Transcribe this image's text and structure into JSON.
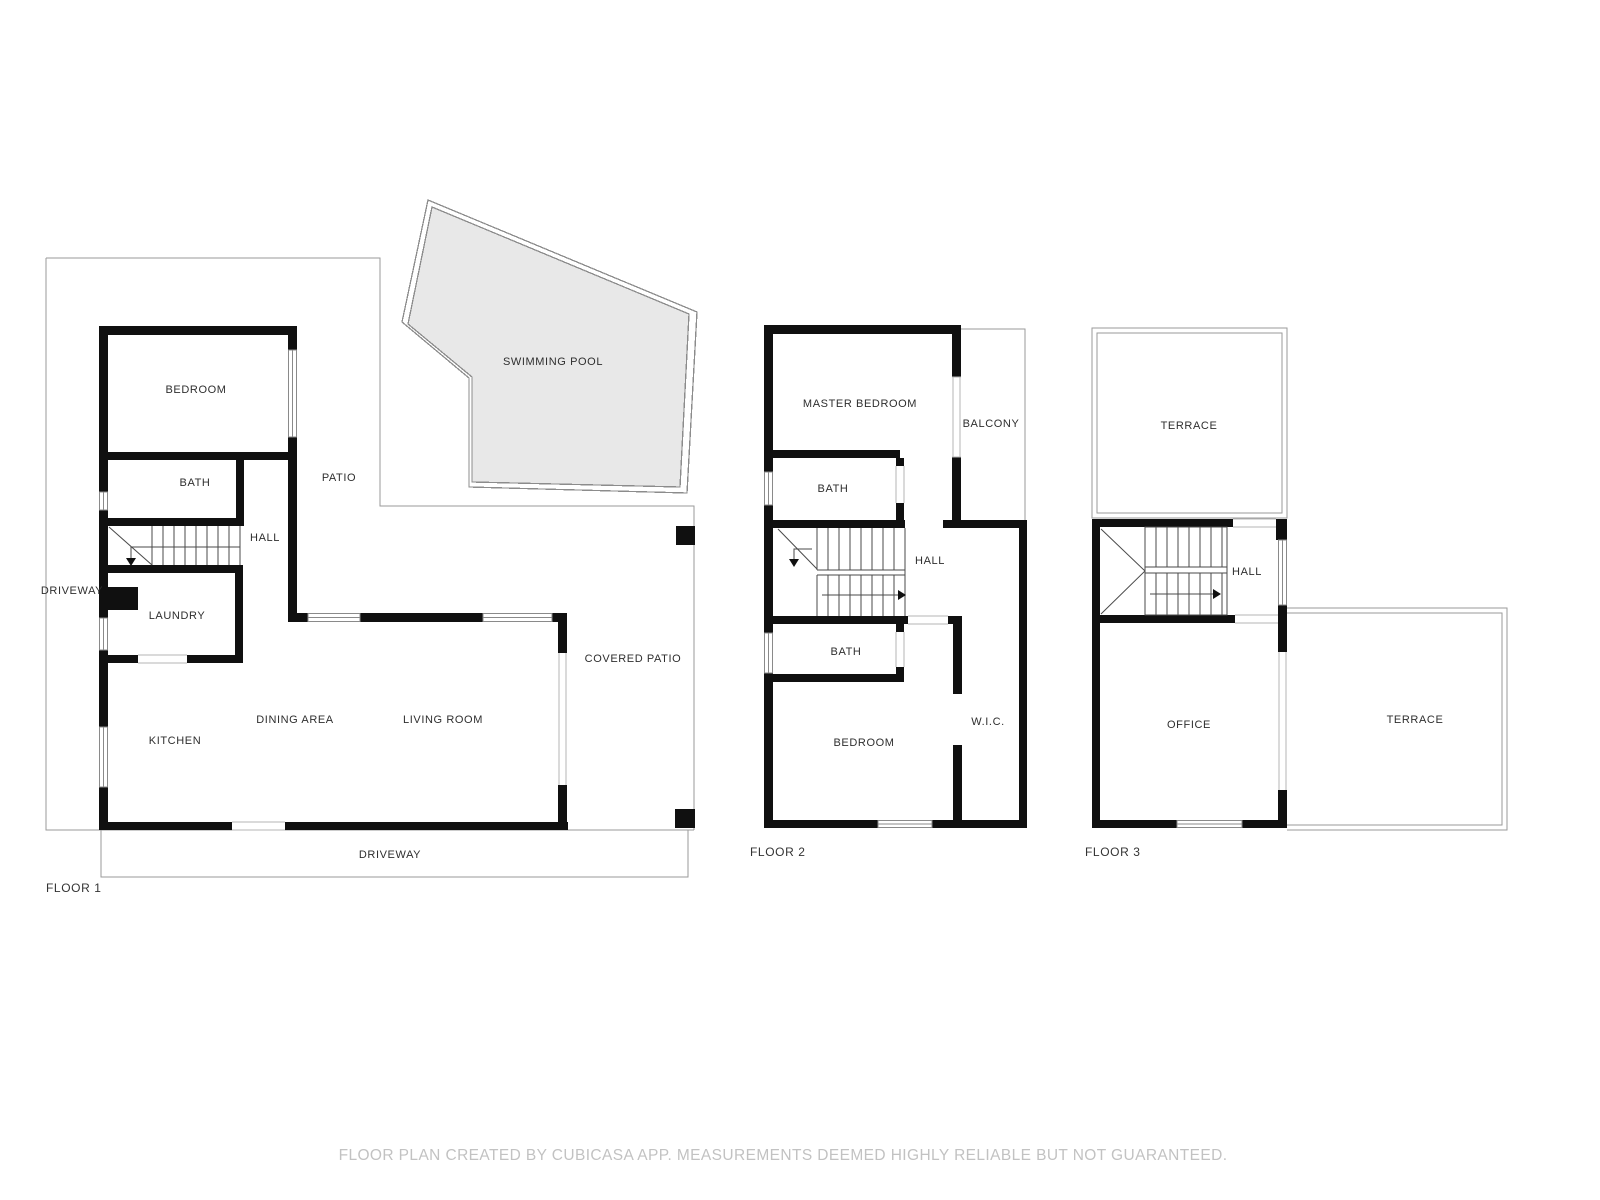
{
  "meta": {
    "colors": {
      "wall": "#101010",
      "thin_line": "#9a9a9a",
      "pool_fill": "#e8e8e8",
      "room_label": "#2e2e2e",
      "floor_label": "#333333",
      "footer_text": "#c2c2c2"
    }
  },
  "floors": [
    {
      "label": "FLOOR 1",
      "rooms": [
        {
          "name": "BEDROOM"
        },
        {
          "name": "BATH"
        },
        {
          "name": "HALL"
        },
        {
          "name": "LAUNDRY"
        },
        {
          "name": "KITCHEN"
        },
        {
          "name": "DINING AREA"
        },
        {
          "name": "LIVING ROOM"
        },
        {
          "name": "COVERED PATIO"
        },
        {
          "name": "PATIO"
        },
        {
          "name": "SWIMMING POOL"
        },
        {
          "name": "DRIVEWAY"
        },
        {
          "name": "DRIVEWAY"
        }
      ]
    },
    {
      "label": "FLOOR 2",
      "rooms": [
        {
          "name": "MASTER BEDROOM"
        },
        {
          "name": "BALCONY"
        },
        {
          "name": "BATH"
        },
        {
          "name": "HALL"
        },
        {
          "name": "BATH"
        },
        {
          "name": "BEDROOM"
        },
        {
          "name": "W.I.C."
        }
      ]
    },
    {
      "label": "FLOOR 3",
      "rooms": [
        {
          "name": "TERRACE"
        },
        {
          "name": "HALL"
        },
        {
          "name": "OFFICE"
        },
        {
          "name": "TERRACE"
        }
      ]
    }
  ],
  "footer": {
    "disclaimer": "FLOOR PLAN CREATED BY CUBICASA APP. MEASUREMENTS DEEMED HIGHLY RELIABLE BUT NOT GUARANTEED."
  }
}
